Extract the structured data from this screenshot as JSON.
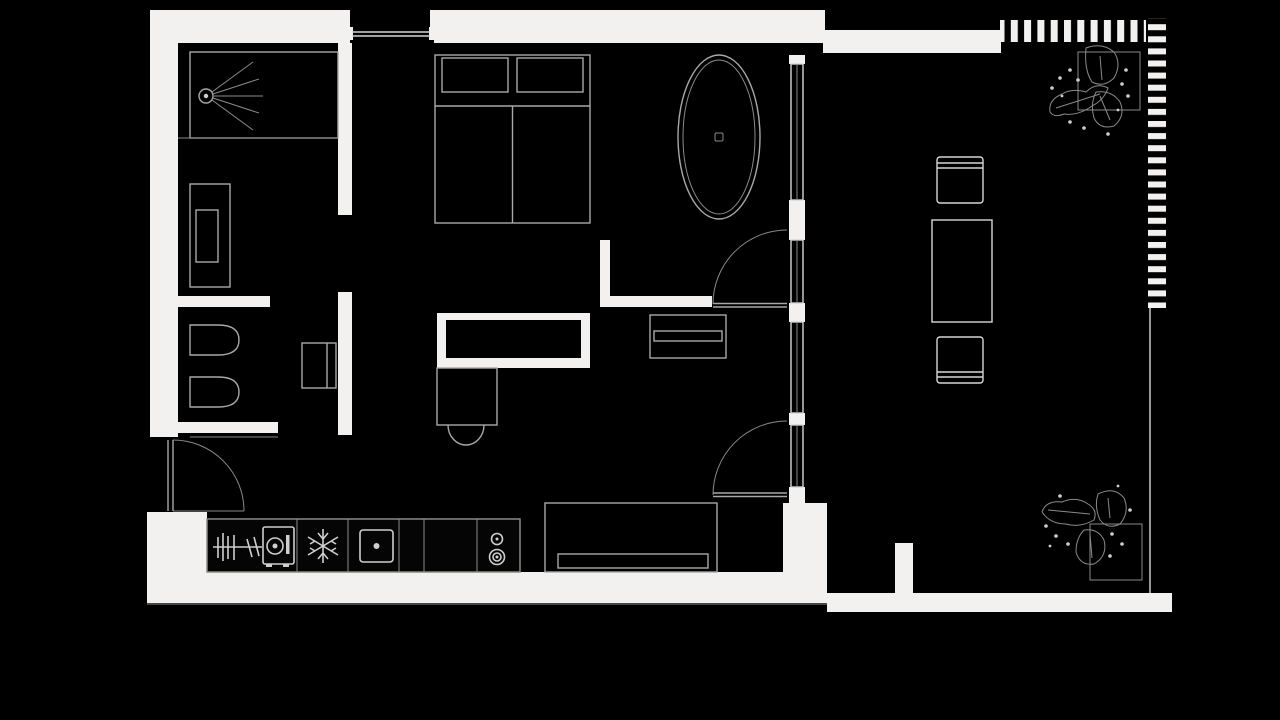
{
  "title": "Black-and-white apartment floor plan with balcony",
  "colors": {
    "background": "#000000",
    "wall": "#f3f1ef",
    "outline": "#a8a8a8",
    "outline_bright": "#d6d6d6",
    "icon": "#cfcfcf",
    "hairline": "#8a8a8a"
  },
  "elements": [
    {
      "id": "shower",
      "label": "Shower with shower-head symbol"
    },
    {
      "id": "vanity",
      "label": "Bathroom vanity cabinet"
    },
    {
      "id": "toilet",
      "label": "Wall-hung toilet"
    },
    {
      "id": "bidet",
      "label": "Bidet"
    },
    {
      "id": "bathroom-cabinet",
      "label": "Small cabinet against corridor wall"
    },
    {
      "id": "double-bed",
      "label": "Double bed with two pillows"
    },
    {
      "id": "bathtub",
      "label": "Freestanding oval bathtub"
    },
    {
      "id": "desk",
      "label": "Desk / table with chair"
    },
    {
      "id": "sideboard",
      "label": "Low sideboard / media unit"
    },
    {
      "id": "sofa",
      "label": "Sofa against bottom wall"
    },
    {
      "id": "kitchen-counter",
      "label": "Kitchen appliance run"
    },
    {
      "id": "dishwasher",
      "label": "Dishwasher rack symbol"
    },
    {
      "id": "washing-machine",
      "label": "Washing machine symbol"
    },
    {
      "id": "freezer",
      "label": "Freezer snowflake symbol"
    },
    {
      "id": "oven",
      "label": "Oven symbol"
    },
    {
      "id": "cooktop",
      "label": "Cooktop with two burners"
    },
    {
      "id": "dining-table",
      "label": "Balcony table with two chairs"
    },
    {
      "id": "plants",
      "label": "Two potted plants on balcony"
    },
    {
      "id": "entry-door",
      "label": "Entry door with swing arc"
    },
    {
      "id": "balcony-doors",
      "label": "Two glazed balcony doors with swing arcs"
    },
    {
      "id": "glazing",
      "label": "Floor-to-ceiling glazed wall"
    },
    {
      "id": "railing",
      "label": "Hatched balcony railing"
    }
  ]
}
